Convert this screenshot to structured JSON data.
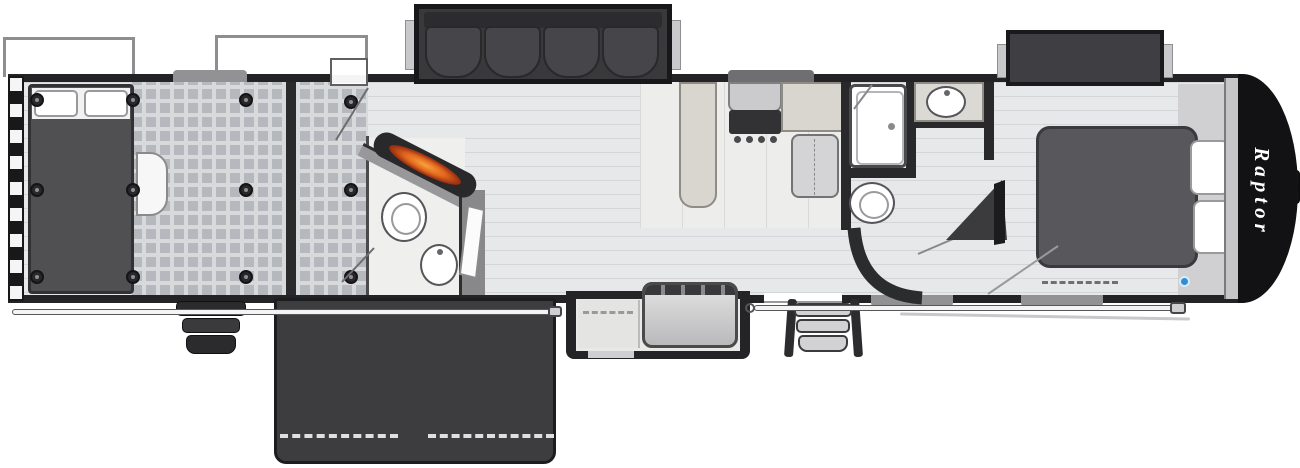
{
  "document": {
    "kind": "rv-toy-hauler-floorplan-illustration"
  },
  "branding": {
    "logo_text": "Raptor"
  },
  "palette": {
    "body_wall": "#232326",
    "interior_floor": "#e7e8e9",
    "garage_checker": "#b5b8bc",
    "furniture_dark": "#47474a",
    "counter_beige": "#d9d6cf",
    "fixture_white": "#ffffff",
    "flame_orange": "#e2661d",
    "patio_dark": "#3d3d40",
    "accent_blue": "#2f8ed8",
    "nose_black": "#121214",
    "logo_white": "#ffffff"
  },
  "features": {
    "exterior": [
      "awning-outline",
      "awning-rod",
      "patio-ramp",
      "patio-railing-dashes",
      "entry-steps",
      "garage-steps",
      "king-pin",
      "front-cap",
      "rear-ramp-hazard-stripe"
    ],
    "garage": [
      "garage-bed",
      "bed-pillows",
      "tie-down-rings",
      "checker-floor",
      "fold-down-table",
      "entry-door",
      "door-swing"
    ],
    "half_bath": [
      "angled-wall",
      "fireplace",
      "toilet",
      "round-sink",
      "open-door-leaf"
    ],
    "living": [
      "sofa-slide-out",
      "sofa-cushions",
      "plank-floor"
    ],
    "kitchen": [
      "peninsula-counter",
      "range",
      "cooktop-burners",
      "refrigerator",
      "island-counter",
      "step-landing"
    ],
    "bathroom": [
      "shower",
      "vanity-sink",
      "toilet",
      "curved-wall",
      "corner-tv"
    ],
    "bedroom": [
      "wardrobe-slide-out",
      "bed",
      "bed-pillows",
      "foot-dashes",
      "marker-dot"
    ]
  }
}
